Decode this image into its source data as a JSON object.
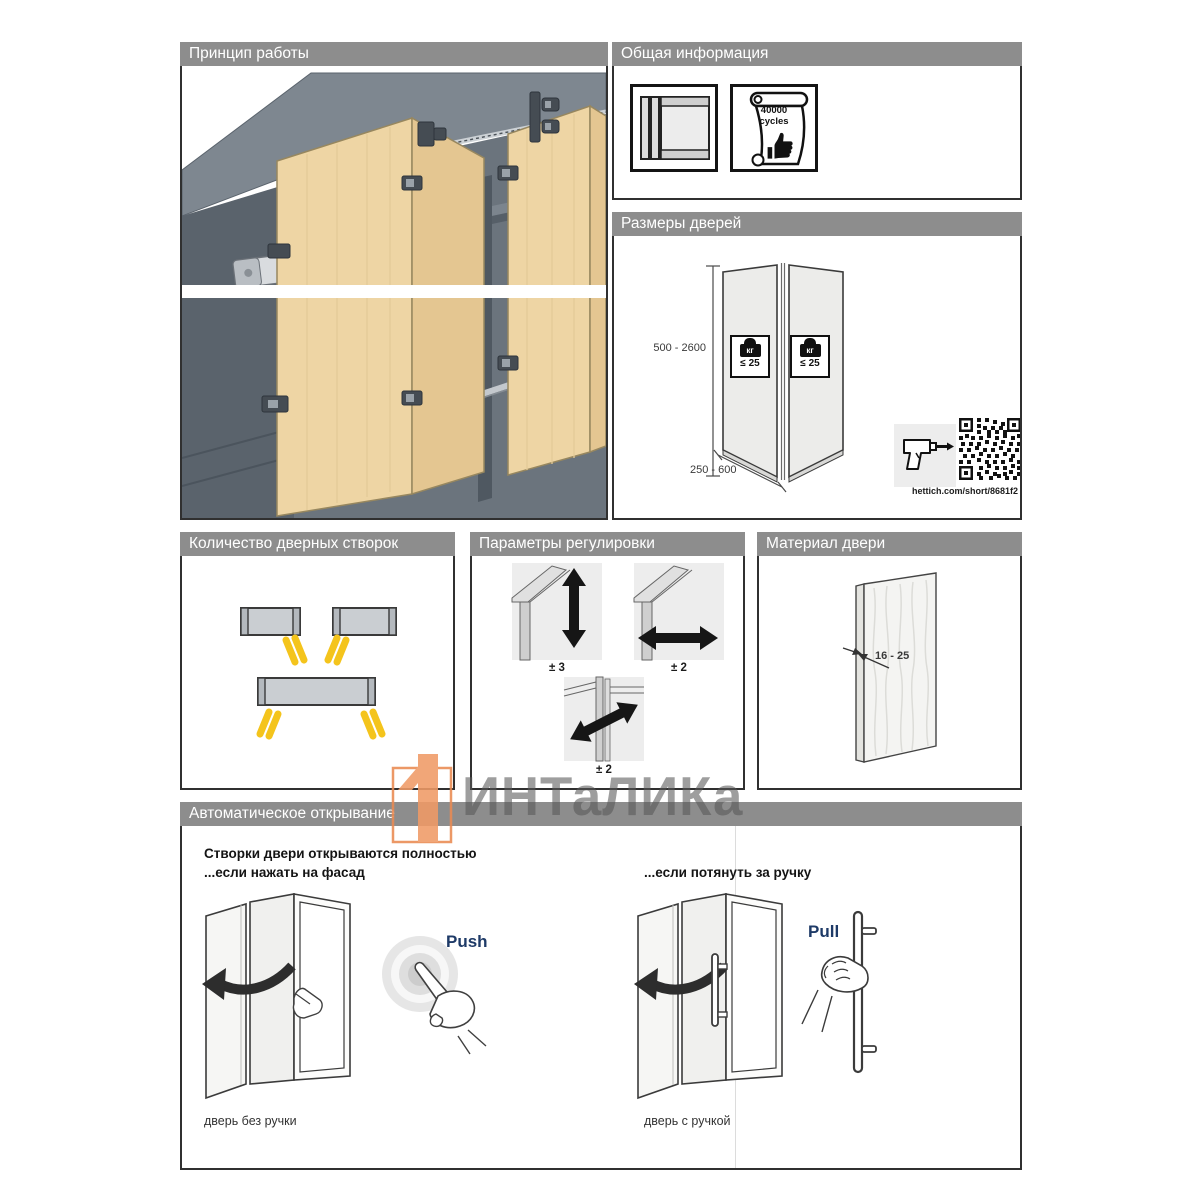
{
  "colors": {
    "header_bg": "#8D8D8D",
    "accent_orange": "#ED8B57",
    "gesture_navy": "#1E3A67",
    "stripe_yellow": "#F4C41C",
    "wood": "#EED5A4"
  },
  "panels": {
    "principle": {
      "title": "Принцип работы"
    },
    "general": {
      "title": "Общая информация",
      "cycles_value": "40000",
      "cycles_unit": "cycles",
      "icons": [
        "folding-door-icon",
        "endurance-scroll-icon",
        "thumbs-up-icon"
      ]
    },
    "sizes": {
      "title": "Размеры дверей",
      "height_range": "500 - 2600",
      "width_range": "250 - 600",
      "weight_unit": "кг",
      "weight_limit": "≤ 25",
      "link": "hettich.com/short/8681f2",
      "icons": [
        "drill-icon",
        "qr-code"
      ]
    },
    "count": {
      "title": "Количество дверных створок"
    },
    "adjust": {
      "title": "Параметры регулировки",
      "vertical_label": "± 3",
      "horizontal_label": "± 2",
      "depth_label": "± 2"
    },
    "material": {
      "title": "Материал двери",
      "thickness_range": "16 - 25"
    },
    "auto": {
      "title": "Автоматическое открывание",
      "headline": "Створки двери открываются полностью",
      "push_condition": "...если нажать на фасад",
      "pull_condition": "...если потянуть за ручку",
      "push_label": "Push",
      "pull_label": "Pull",
      "caption_no_handle": "дверь без ручки",
      "caption_handle": "дверь с ручкой"
    }
  },
  "watermark": {
    "text": "ИНТаЛИКа",
    "logo": "intalika-logo-icon"
  }
}
